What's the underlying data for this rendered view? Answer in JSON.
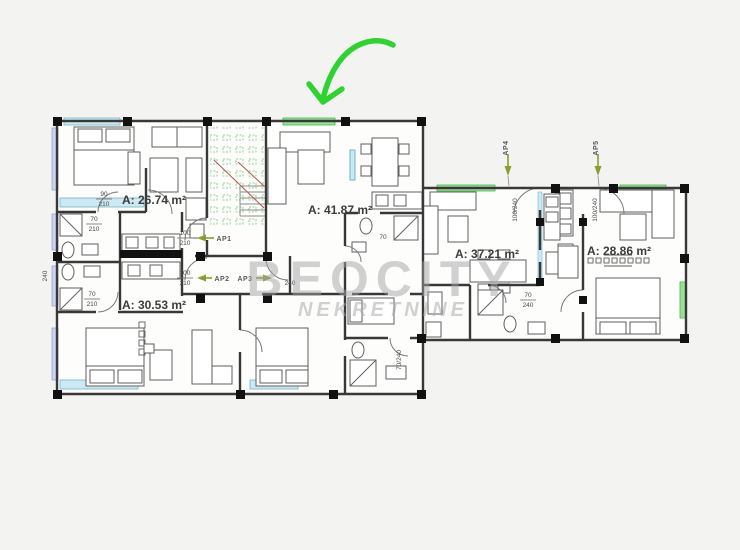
{
  "image_type": "real-estate floor plan photo with agency watermark",
  "watermark": {
    "line1": "BEOCITY",
    "line2": "NEKRETNINE"
  },
  "apartments": {
    "a1": {
      "area_label": "A: 26.74 m²"
    },
    "a2": {
      "area_label": "A: 41.87 m²"
    },
    "a3": {
      "area_label": "A: 30.53 m²"
    },
    "a4": {
      "area_label": "A: 37.21 m²"
    },
    "a5": {
      "area_label": "A: 28.86 m²"
    }
  },
  "markers": {
    "ap1": "AP1",
    "ap2": "AP2",
    "ap3": "AP3",
    "ap4": "AP4",
    "ap5": "AP5"
  },
  "dims": {
    "d1a": "90",
    "d1b": "210",
    "d2a": "70",
    "d2b": "210",
    "d3a": "100",
    "d3b": "210",
    "d4a": "100",
    "d4b": "210",
    "d5": "240",
    "d6a": "70",
    "d6b": "210",
    "d7": "70",
    "d8a": "70",
    "d8b": "240",
    "d9": "100/240",
    "d10": "100/240",
    "d11": "240",
    "d12": "70/240"
  },
  "colors": {
    "entrance_arrow_green": "#2fd32f",
    "window_green": "#97e293",
    "window_cyan": "#cdeaf4",
    "window_lavender": "#ccd4ef",
    "stair_grid_green": "#7cc97c",
    "stair_red": "#b85450",
    "marker_olive": "#8a9e2f",
    "watermark_gray": "#a5a5a5",
    "wall_dark": "#383838"
  }
}
